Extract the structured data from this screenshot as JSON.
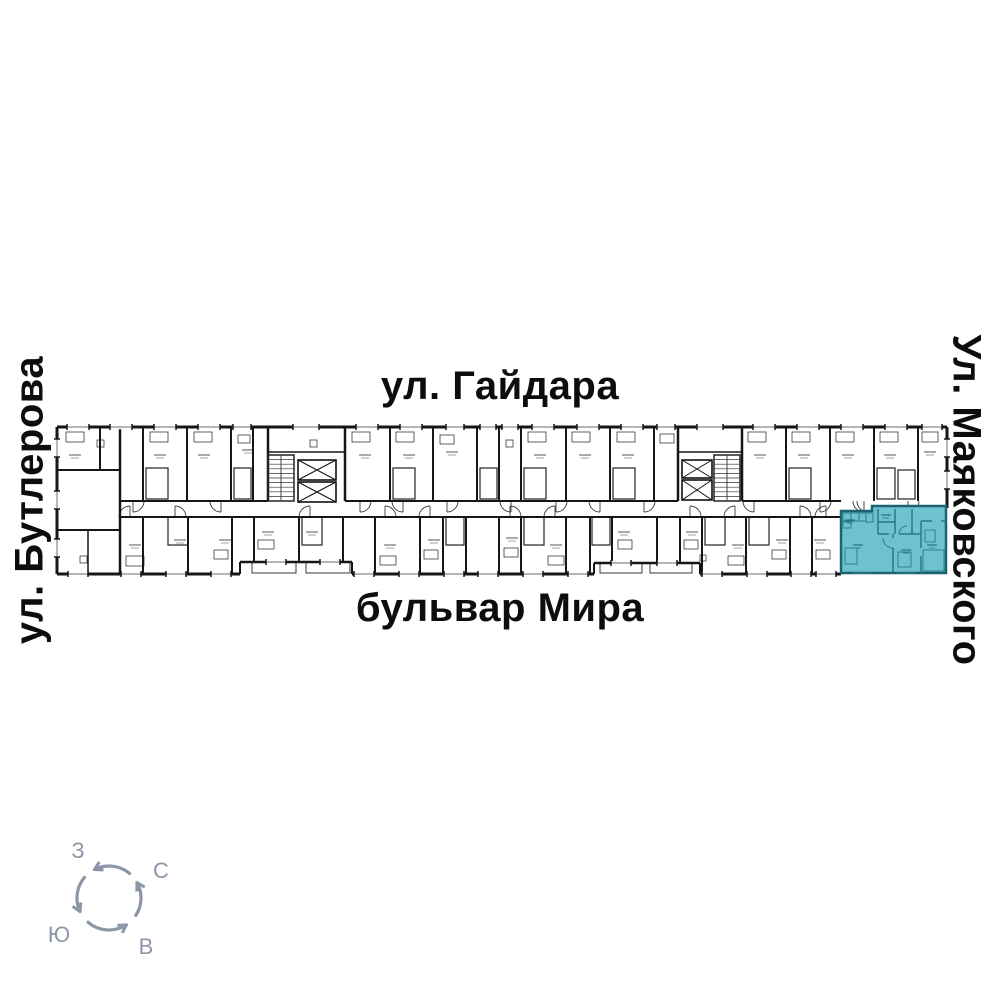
{
  "streets": {
    "top": "ул. Гайдара",
    "bottom": "бульвар Мира",
    "left": "ул. Бутлерова",
    "right": "Ул. Маяковского"
  },
  "compass": {
    "west": "З",
    "north": "С",
    "south": "Ю",
    "east": "В",
    "color": "#8c96a8",
    "cx": 109,
    "cy": 898,
    "r": 32,
    "arcs": [
      [
        50,
        117
      ],
      [
        140,
        205
      ],
      [
        229,
        303
      ],
      [
        327,
        389
      ]
    ],
    "label_pos": {
      "west": [
        78,
        851
      ],
      "north": [
        161,
        871
      ],
      "south": [
        59,
        935
      ],
      "east": [
        146,
        947
      ]
    }
  },
  "highlight": {
    "color": "#6ec2ce",
    "wall_color": "#1b6372",
    "inner_color": "#27798a",
    "outline": [
      [
        841,
        511
      ],
      [
        872,
        511
      ],
      [
        872,
        506
      ],
      [
        946,
        506
      ],
      [
        946,
        573
      ],
      [
        841,
        573
      ]
    ],
    "inner_walls": [
      [
        878,
        509,
        878,
        534
      ],
      [
        895,
        509,
        895,
        534
      ],
      [
        912,
        509,
        912,
        534
      ],
      [
        878,
        522,
        895,
        522
      ],
      [
        878,
        534,
        889,
        534
      ],
      [
        899,
        534,
        921,
        534
      ],
      [
        893,
        534,
        893,
        538
      ],
      [
        893,
        548,
        893,
        573
      ],
      [
        921,
        521,
        921,
        548
      ],
      [
        921,
        556,
        921,
        573
      ],
      [
        921,
        521,
        932,
        521
      ],
      [
        941,
        521,
        946,
        521
      ]
    ],
    "boxes": [
      [
        843,
        513,
        8,
        8
      ],
      [
        851,
        513,
        8,
        8
      ],
      [
        859,
        513,
        7,
        8
      ],
      [
        843,
        522,
        8,
        6
      ],
      [
        866,
        513,
        7,
        9
      ],
      [
        845,
        548,
        12,
        16
      ],
      [
        898,
        552,
        13,
        15
      ],
      [
        925,
        530,
        10,
        12
      ],
      [
        923,
        550,
        21,
        21
      ]
    ],
    "doors": [
      "M893,548 A10,10 0 0 1 883,538",
      "M899,534 A8,8 0 0 1 907,526"
    ],
    "windows": [
      [
        862,
        573
      ],
      [
        906,
        573
      ]
    ],
    "marks": [
      [
        858,
        545
      ],
      [
        906,
        550
      ],
      [
        932,
        545
      ],
      [
        886,
        515
      ],
      [
        850,
        520
      ]
    ]
  },
  "floorplan": {
    "ink": "#161616",
    "detail": "#3a3a3a",
    "faint": "#8a8a8a",
    "outer": {
      "top": [
        57,
        427,
        947,
        427,
        3
      ],
      "left": [
        57,
        427,
        57,
        574,
        3
      ],
      "right": [
        947,
        427,
        947,
        508,
        3
      ],
      "bottom": [
        [
          57,
          574,
          240,
          574,
          3
        ],
        [
          240,
          574,
          240,
          562,
          2
        ],
        [
          240,
          562,
          352,
          562,
          2.5
        ],
        [
          352,
          562,
          352,
          574,
          2
        ],
        [
          352,
          574,
          594,
          574,
          3
        ],
        [
          594,
          574,
          594,
          563,
          2
        ],
        [
          594,
          563,
          700,
          563,
          2.5
        ],
        [
          700,
          563,
          700,
          574,
          2
        ],
        [
          700,
          574,
          841,
          574,
          3
        ]
      ]
    },
    "corridor": {
      "y_top": 501,
      "y_bot": 517,
      "top_segs": [
        [
          120,
          268
        ],
        [
          345,
          678
        ],
        [
          742,
          841
        ]
      ],
      "bot_segs": [
        [
          120,
          841
        ]
      ]
    },
    "left_block": [
      [
        100,
        427,
        100,
        470,
        2
      ],
      [
        57,
        470,
        120,
        470,
        2
      ],
      [
        120,
        427,
        120,
        574,
        2.5
      ],
      [
        57,
        530,
        120,
        530,
        2
      ],
      [
        88,
        530,
        88,
        574,
        1.5
      ]
    ],
    "top_wall_xs": [
      143,
      187,
      231,
      253,
      390,
      433,
      477,
      499,
      521,
      566,
      610,
      654,
      786,
      830,
      874,
      918
    ],
    "core_wall_xs": [
      268,
      345,
      678,
      742
    ],
    "bottom_walls": [
      [
        143,
        574
      ],
      [
        188,
        574
      ],
      [
        232,
        574
      ],
      [
        254,
        562
      ],
      [
        299,
        562
      ],
      [
        343,
        562
      ],
      [
        375,
        574
      ],
      [
        420,
        574
      ],
      [
        443,
        574
      ],
      [
        466,
        574
      ],
      [
        499,
        574
      ],
      [
        521,
        574
      ],
      [
        566,
        574
      ],
      [
        590,
        574
      ],
      [
        612,
        563
      ],
      [
        657,
        563
      ],
      [
        680,
        563
      ],
      [
        702,
        574
      ],
      [
        746,
        574
      ],
      [
        790,
        574
      ],
      [
        812,
        574
      ]
    ],
    "windows_top": [
      [
        78,
        22
      ],
      [
        121,
        22
      ],
      [
        165,
        22
      ],
      [
        209,
        22
      ],
      [
        242,
        18
      ],
      [
        306,
        26
      ],
      [
        367,
        22
      ],
      [
        411,
        22
      ],
      [
        455,
        18
      ],
      [
        488,
        16
      ],
      [
        510,
        16
      ],
      [
        543,
        22
      ],
      [
        588,
        22
      ],
      [
        632,
        22
      ],
      [
        666,
        18
      ],
      [
        710,
        26
      ],
      [
        764,
        22
      ],
      [
        808,
        22
      ],
      [
        852,
        22
      ],
      [
        896,
        22
      ],
      [
        932,
        20
      ]
    ],
    "windows_bottom": [
      [
        78,
        574
      ],
      [
        131,
        574
      ],
      [
        176,
        574
      ],
      [
        221,
        574
      ],
      [
        276,
        562
      ],
      [
        330,
        562
      ],
      [
        364,
        574
      ],
      [
        409,
        574
      ],
      [
        454,
        574
      ],
      [
        488,
        574
      ],
      [
        533,
        574
      ],
      [
        578,
        574
      ],
      [
        621,
        563
      ],
      [
        667,
        563
      ],
      [
        712,
        574
      ],
      [
        757,
        574
      ],
      [
        801,
        574
      ],
      [
        826,
        574
      ]
    ],
    "windows_left_ys": [
      448,
      500,
      548
    ],
    "windows_right_ys": [
      448,
      480
    ],
    "balconies": [
      [
        252,
        562,
        44,
        11
      ],
      [
        306,
        562,
        44,
        11
      ],
      [
        600,
        563,
        42,
        10
      ],
      [
        650,
        563,
        42,
        10
      ]
    ],
    "arcs_top_xs": [
      133,
      221,
      360,
      403,
      447,
      511,
      556,
      600,
      644,
      754,
      820,
      864,
      908
    ],
    "arcs_bot_xs": [
      130,
      175,
      310,
      385,
      430,
      510,
      555,
      690,
      735,
      800,
      826
    ],
    "extra_paths": [
      "M868,512 A11,11 0 0 1 857,501"
    ],
    "inner_boxes": [
      [
        146,
        468,
        22,
        31
      ],
      [
        234,
        468,
        17,
        31
      ],
      [
        393,
        468,
        22,
        31
      ],
      [
        480,
        468,
        17,
        31
      ],
      [
        524,
        468,
        22,
        31
      ],
      [
        613,
        468,
        22,
        31
      ],
      [
        789,
        468,
        22,
        31
      ],
      [
        877,
        468,
        18,
        31
      ],
      [
        898,
        470,
        17,
        29
      ],
      [
        168,
        517,
        20,
        28
      ],
      [
        302,
        517,
        20,
        28
      ],
      [
        446,
        517,
        18,
        28
      ],
      [
        524,
        517,
        20,
        28
      ],
      [
        592,
        517,
        18,
        28
      ],
      [
        705,
        517,
        20,
        28
      ],
      [
        749,
        517,
        20,
        28
      ]
    ],
    "furniture": [
      [
        66,
        432,
        18,
        10
      ],
      [
        150,
        432,
        18,
        10
      ],
      [
        194,
        432,
        18,
        10
      ],
      [
        238,
        435,
        12,
        8
      ],
      [
        352,
        432,
        18,
        10
      ],
      [
        396,
        432,
        18,
        10
      ],
      [
        440,
        435,
        14,
        9
      ],
      [
        528,
        432,
        18,
        10
      ],
      [
        572,
        432,
        18,
        10
      ],
      [
        617,
        432,
        18,
        10
      ],
      [
        660,
        434,
        14,
        9
      ],
      [
        748,
        432,
        18,
        10
      ],
      [
        792,
        432,
        18,
        10
      ],
      [
        836,
        432,
        18,
        10
      ],
      [
        880,
        432,
        18,
        10
      ],
      [
        922,
        432,
        16,
        10
      ],
      [
        126,
        556,
        18,
        10
      ],
      [
        214,
        550,
        14,
        9
      ],
      [
        258,
        540,
        16,
        9
      ],
      [
        380,
        556,
        16,
        9
      ],
      [
        424,
        550,
        14,
        9
      ],
      [
        504,
        548,
        14,
        9
      ],
      [
        548,
        556,
        16,
        9
      ],
      [
        618,
        540,
        14,
        9
      ],
      [
        684,
        540,
        14,
        9
      ],
      [
        728,
        556,
        16,
        9
      ],
      [
        772,
        550,
        14,
        9
      ],
      [
        816,
        550,
        14,
        9
      ],
      [
        97,
        440,
        7,
        7
      ],
      [
        310,
        440,
        7,
        7
      ],
      [
        506,
        440,
        7,
        7
      ],
      [
        700,
        555,
        6,
        6
      ],
      [
        80,
        556,
        7,
        7
      ]
    ],
    "text_marks": [
      [
        75,
        455
      ],
      [
        160,
        455
      ],
      [
        204,
        455
      ],
      [
        248,
        450
      ],
      [
        365,
        455
      ],
      [
        409,
        455
      ],
      [
        452,
        452
      ],
      [
        540,
        455
      ],
      [
        585,
        455
      ],
      [
        628,
        455
      ],
      [
        760,
        455
      ],
      [
        804,
        455
      ],
      [
        848,
        455
      ],
      [
        890,
        455
      ],
      [
        930,
        452
      ],
      [
        135,
        545
      ],
      [
        180,
        540
      ],
      [
        225,
        540
      ],
      [
        268,
        532
      ],
      [
        312,
        532
      ],
      [
        390,
        545
      ],
      [
        434,
        540
      ],
      [
        512,
        538
      ],
      [
        556,
        545
      ],
      [
        624,
        532
      ],
      [
        692,
        532
      ],
      [
        738,
        545
      ],
      [
        782,
        540
      ],
      [
        820,
        540
      ]
    ],
    "cores": [
      {
        "stairs": [
          268,
          455,
          26,
          46
        ],
        "lifts": [
          [
            298,
            460,
            38,
            20
          ],
          [
            298,
            482,
            38,
            20
          ]
        ],
        "lobby": [
          268,
          452,
          345,
          452
        ]
      },
      {
        "stairs": [
          714,
          455,
          26,
          46
        ],
        "lifts": [
          [
            682,
            460,
            30,
            18
          ],
          [
            682,
            480,
            30,
            20
          ]
        ],
        "lobby": [
          678,
          452,
          742,
          452
        ]
      }
    ]
  }
}
